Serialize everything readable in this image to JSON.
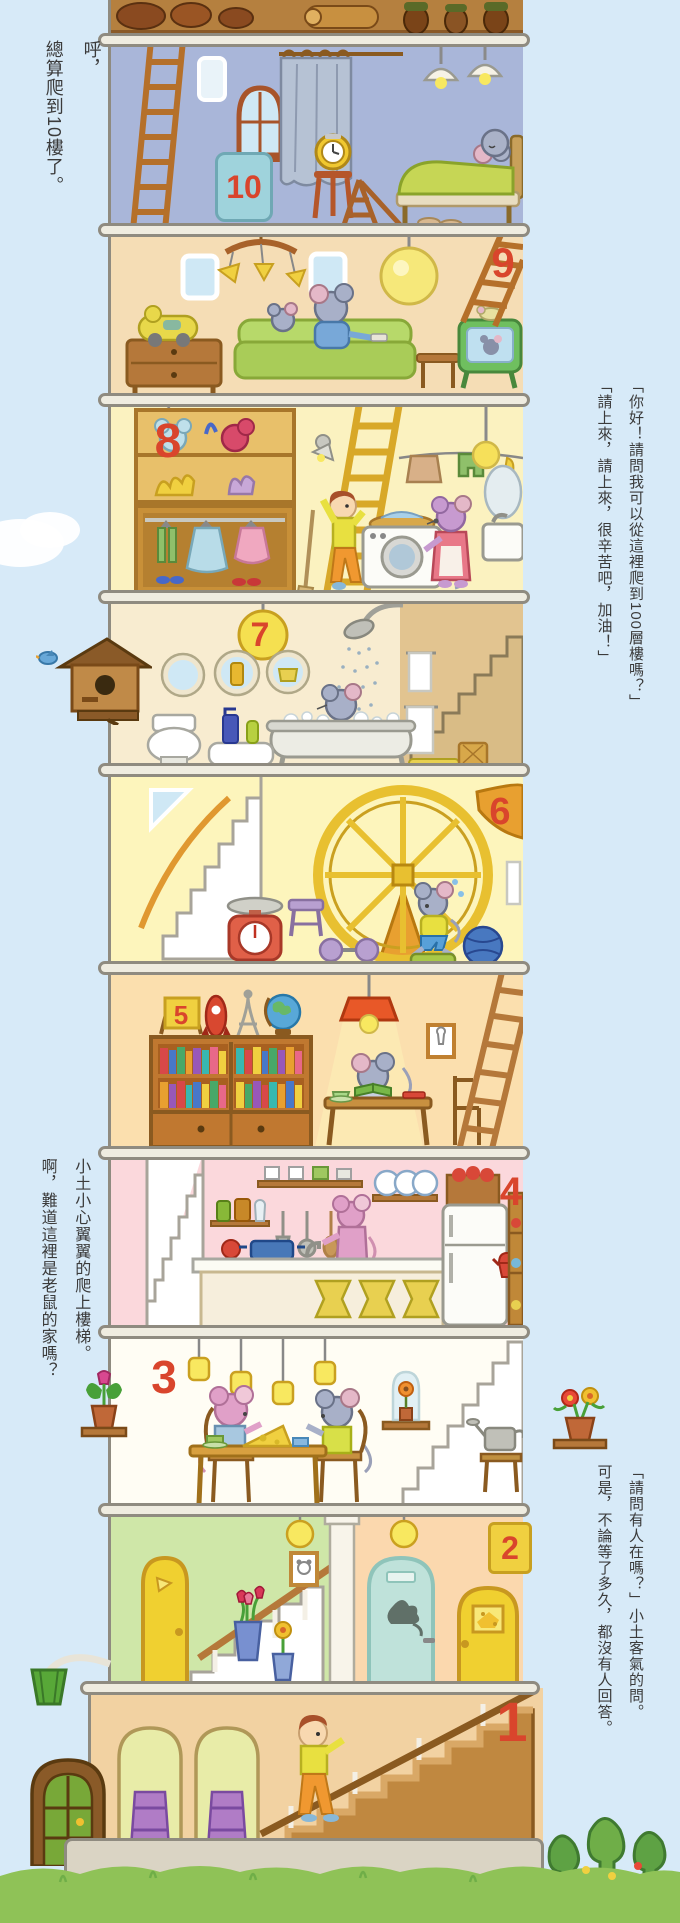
{
  "narration": {
    "huff": [
      "呼，",
      "總算爬到10樓了。"
    ],
    "greeting": [
      "「你好！請問我可以從這裡爬到100層樓嗎？」",
      "「請上來，請上來，很辛苦吧，加油！」"
    ],
    "climb": [
      "小土小心翼翼的爬上樓梯。",
      "啊，難道這裡是老鼠的家嗎？"
    ],
    "knock": [
      "「請問有人在嗎？」小土客氣的問。",
      "可是，不論等了多久，都沒有人回答。"
    ]
  },
  "floor_numbers": {
    "f1": "1",
    "f2": "2",
    "f3": "3",
    "f4": "4",
    "f5": "5",
    "f6": "6",
    "f7": "7",
    "f8": "8",
    "f9": "9",
    "f10": "10"
  },
  "palette": {
    "sky": "#d7eaf8",
    "outline": "#8f8b80",
    "slab": "#efece0",
    "number_red": "#d9452c",
    "floor10_wall": "#a9b6d9",
    "floor9_wall": "#f5ddb5",
    "floor8_wall": "#fbf2c0",
    "floor7_wall": "#f8ecd0",
    "floor6_wall": "#fdf5bc",
    "floor5_wall": "#fbdfae",
    "floor4_wall": "#fbd8dc",
    "floor3_wall": "#fffdf4",
    "floor2_wall_left": "#cfe7a8",
    "floor2_wall_right": "#fbd8ae",
    "floor1_wall": "#f2d2a2",
    "wood": "#b5783a",
    "grass": "#8fc257",
    "tree": "#5ea244"
  }
}
